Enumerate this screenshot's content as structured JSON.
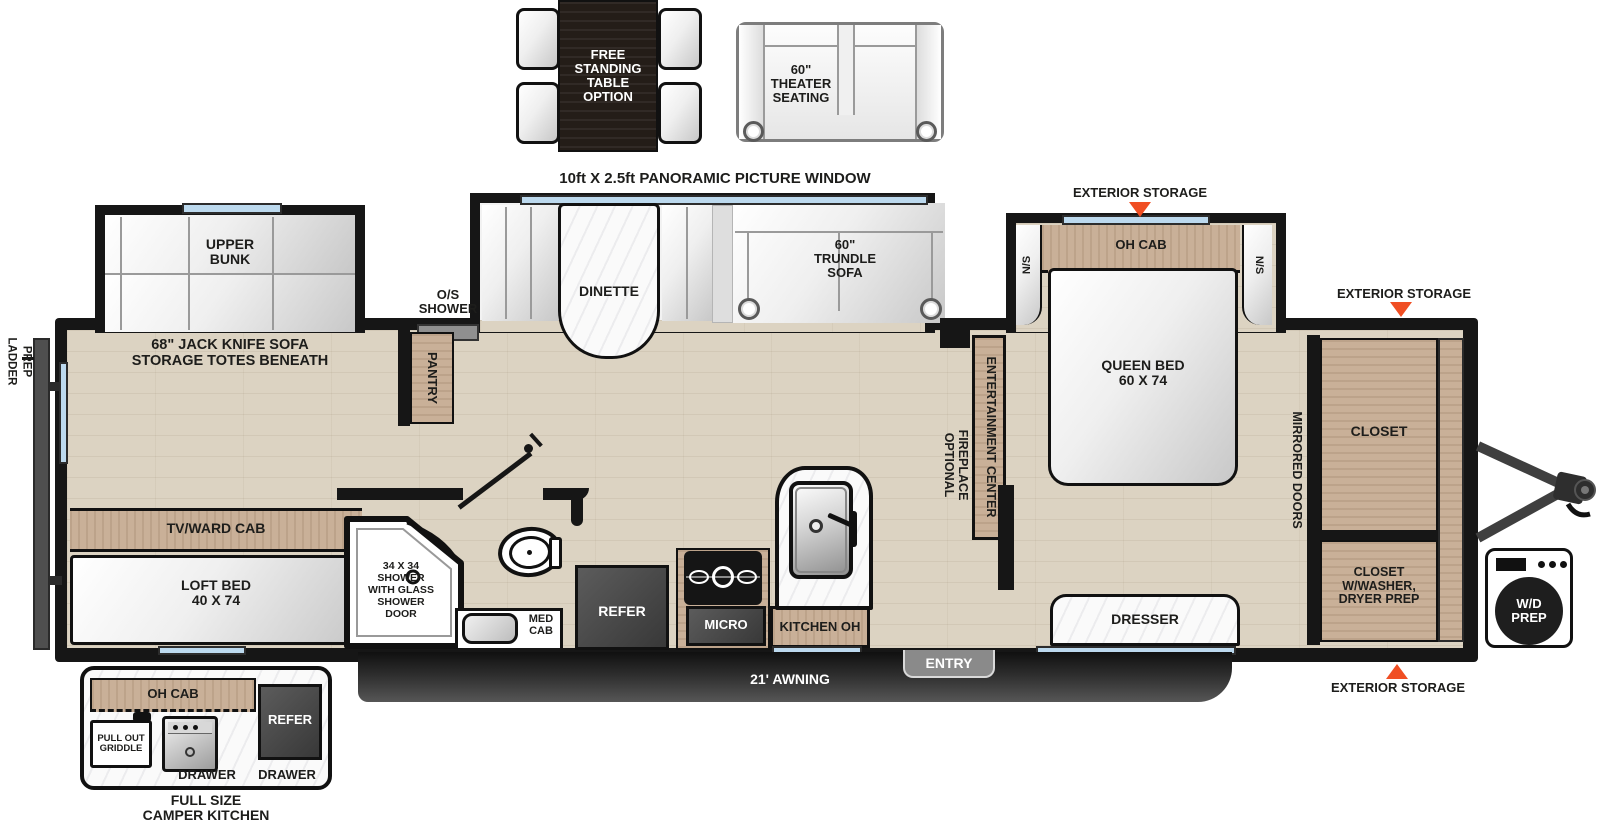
{
  "top_inset": {
    "table_line1": "FREE",
    "table_line2": "STANDING",
    "table_line3": "TABLE",
    "table_line4": "OPTION",
    "theater_line1": "60\"",
    "theater_line2": "THEATER",
    "theater_line3": "SEATING"
  },
  "window_label": "10ft X 2.5ft PANORAMIC PICTURE WINDOW",
  "exterior": {
    "storage_top": "EXTERIOR STORAGE",
    "storage_right": "EXTERIOR STORAGE",
    "storage_bottom": "EXTERIOR STORAGE",
    "ladder_line1": "LADDER",
    "ladder_line2": "PREP",
    "os_shower_line1": "O/S",
    "os_shower_line2": "SHOWER",
    "awning": "21' AWNING",
    "entry": "ENTRY"
  },
  "living": {
    "upper_bunk_line1": "UPPER",
    "upper_bunk_line2": "BUNK",
    "jack_knife_line1": "68\" JACK KNIFE SOFA",
    "jack_knife_line2": "STORAGE TOTES BENEATH",
    "pantry": "PANTRY",
    "dinette": "DINETTE",
    "trundle_line1": "60\"",
    "trundle_line2": "TRUNDLE",
    "trundle_line3": "SOFA",
    "tv_ward_cab": "TV/WARD CAB",
    "loft_bed_line1": "LOFT BED",
    "loft_bed_line2": "40 X 74",
    "shower_line1": "34 X 34",
    "shower_line2": "SHOWER",
    "shower_line3": "WITH GLASS",
    "shower_line4": "SHOWER",
    "shower_line5": "DOOR",
    "med_cab_line1": "MED",
    "med_cab_line2": "CAB",
    "refer": "REFER",
    "micro": "MICRO",
    "kitchen_oh": "KITCHEN OH",
    "entertainment_center": "ENTERTAINMENT CENTER",
    "optional": "OPTIONAL",
    "fireplace": "FIREPLACE"
  },
  "bedroom": {
    "oh_cab": "OH CAB",
    "ns": "N/S",
    "queen_line1": "QUEEN BED",
    "queen_line2": "60 X 74",
    "dresser": "DRESSER",
    "mirrored_doors": "MIRRORED DOORS"
  },
  "front": {
    "closet": "CLOSET",
    "closet_washer_line1": "CLOSET",
    "closet_washer_line2": "W/WASHER,",
    "closet_washer_line3": "DRYER PREP",
    "wd_line1": "W/D",
    "wd_line2": "PREP"
  },
  "camper_kitchen": {
    "oh_cab": "OH CAB",
    "griddle_line1": "PULL OUT",
    "griddle_line2": "GRIDDLE",
    "refer": "REFER",
    "drawer_left": "DRAWER",
    "drawer_right": "DRAWER",
    "caption_line1": "FULL SIZE",
    "caption_line2": "CAMPER KITCHEN"
  },
  "colors": {
    "accent_orange": "#f04e23",
    "wall_black": "#161616",
    "window_blue": "#bcd9ee",
    "cabinet_wood": "#c9b098",
    "appliance_dark": "#4a4a4a"
  }
}
